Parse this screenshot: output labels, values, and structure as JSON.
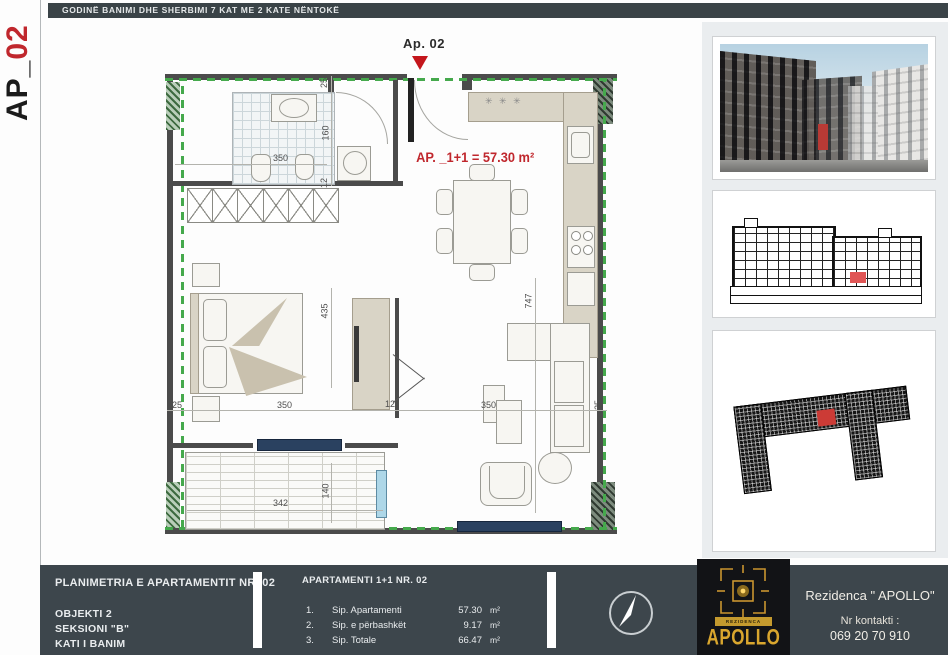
{
  "header": {
    "title": "GODINË BANIMI DHE SHERBIMI 7 KAT ME 2 KATE NËNTOKË"
  },
  "side_tab": {
    "prefix": "AP_",
    "number": "02"
  },
  "plan": {
    "unit_marker": "Ap. 02",
    "area_label": "AP. _1+1 = 57.30 m²",
    "vent_symbol": "✳ ✳ ✳",
    "dims": {
      "top_25": "25",
      "top_160": "160",
      "top_12": "12",
      "bath_350": "350",
      "bed_435": "435",
      "left_25": "25",
      "bed_350": "350",
      "mid_12": "12",
      "living_350": "350",
      "right_25": "25",
      "living_747": "747",
      "balcony_342": "342",
      "balcony_140": "140"
    }
  },
  "title_block": {
    "left": {
      "title": "PLANIMETRIA E APARTAMENTIT NR. 02",
      "lines": [
        "OBJEKTI 2",
        "SEKSIONI \"B\"",
        "KATI  I  BANIM"
      ]
    },
    "table": {
      "header": "APARTAMENTI 1+1 NR. 02",
      "rows": [
        {
          "no": "1.",
          "label": "Sip. Apartamenti",
          "value": "57.30",
          "unit": "m²"
        },
        {
          "no": "2.",
          "label": "Sip. e përbashkët",
          "value": "9.17",
          "unit": "m²"
        },
        {
          "no": "3.",
          "label": "Sip. Totale",
          "value": "66.47",
          "unit": "m²"
        }
      ]
    },
    "brand": {
      "residence": "Rezidenca \" APOLLO\"",
      "contact_label": "Nr kontakti :",
      "phone": "069 20 70 910",
      "logo_banner": "REZIDENCA",
      "logo_text": "APOLLO"
    }
  },
  "colors": {
    "accent_red": "#c0272d",
    "boundary_green": "#45a94c",
    "bar_slate": "#3d464c",
    "gold": "#d9a62e",
    "radiator_navy": "#2a4160"
  }
}
